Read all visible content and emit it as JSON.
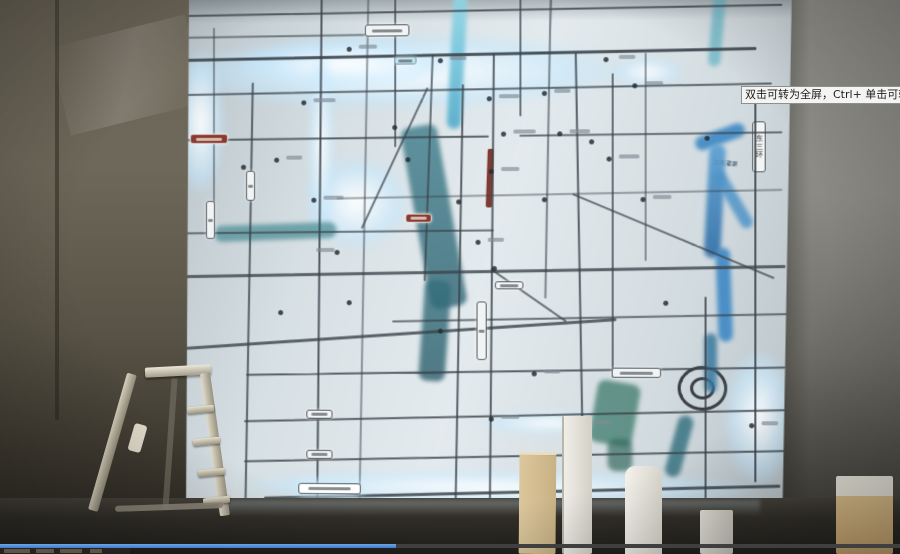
{
  "player": {
    "tooltip_text": "双击可转为全屏，Ctrl+ 单击可转为",
    "progress_percent": 44
  },
  "map": {
    "labels": {
      "east_third_ring_road": "东三环",
      "canal": "沈抚灌渠"
    }
  },
  "colors": {
    "progress_played": "#3f7ccc",
    "progress_remaining": "#3f3f3f",
    "map_glow": "#d9f2ff",
    "river_blue": "#3e88c4",
    "river_teal": "#3f7d8c",
    "accent_red": "#8a3a30"
  }
}
